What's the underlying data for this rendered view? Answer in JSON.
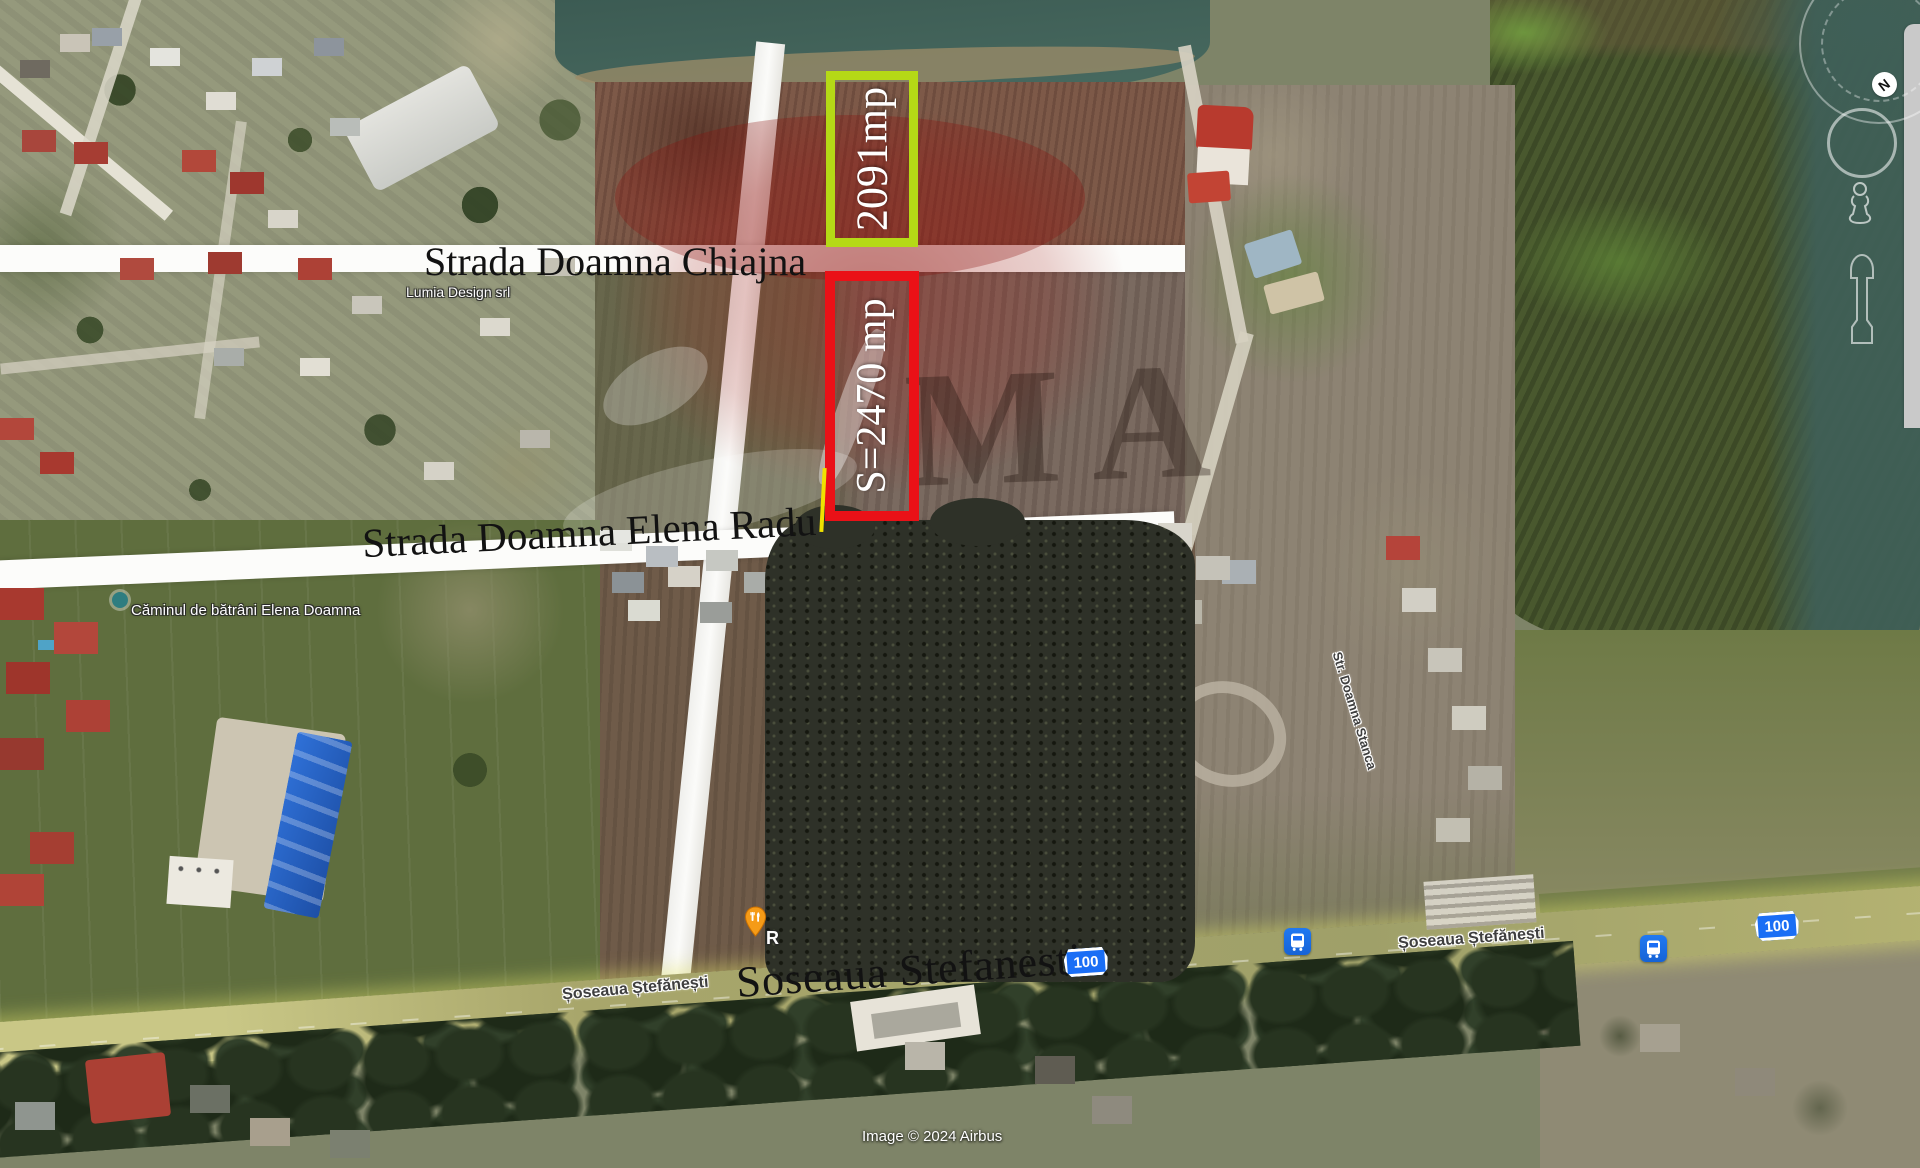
{
  "streets": {
    "chiajna": "Strada Doamna Chiajna",
    "elena_radu": "Strada Doamna Elena Radu",
    "stefanesti_main": "Soseaua Stefanesti",
    "stefanesti_left": "Șoseaua Ștefănești",
    "stefanesti_right": "Șoseaua Ștefănești",
    "doamna_stanca": "Str. Doamna Stanca"
  },
  "annotations": {
    "plot_small": {
      "label": "2091mp",
      "border_color": "#b5d916"
    },
    "plot_large": {
      "label": "S=2470 mp",
      "border_color": "#ea1117"
    }
  },
  "pois": {
    "nursing_home": "Căminul de bătrâni Elena Doamna",
    "business": "Lumia Design srl",
    "restaurant_partial": "R"
  },
  "road_shields": {
    "left": "100",
    "right": "100"
  },
  "transit": {
    "bus_stop_icon": "bus-stop",
    "count": 2
  },
  "compass": {
    "north": "N"
  },
  "watermark": {
    "visible_letters": "MA"
  },
  "attribution": "Image © 2024 Airbus",
  "colors": {
    "plot_small_border": "#b5d916",
    "plot_large_border": "#ea1117",
    "shield_blue": "#1a6ef5",
    "bus_icon_blue": "#1a73e8",
    "water_teal": "#41625a",
    "highway_yellow": "#c9c786",
    "road_white": "#fcfcfa"
  }
}
